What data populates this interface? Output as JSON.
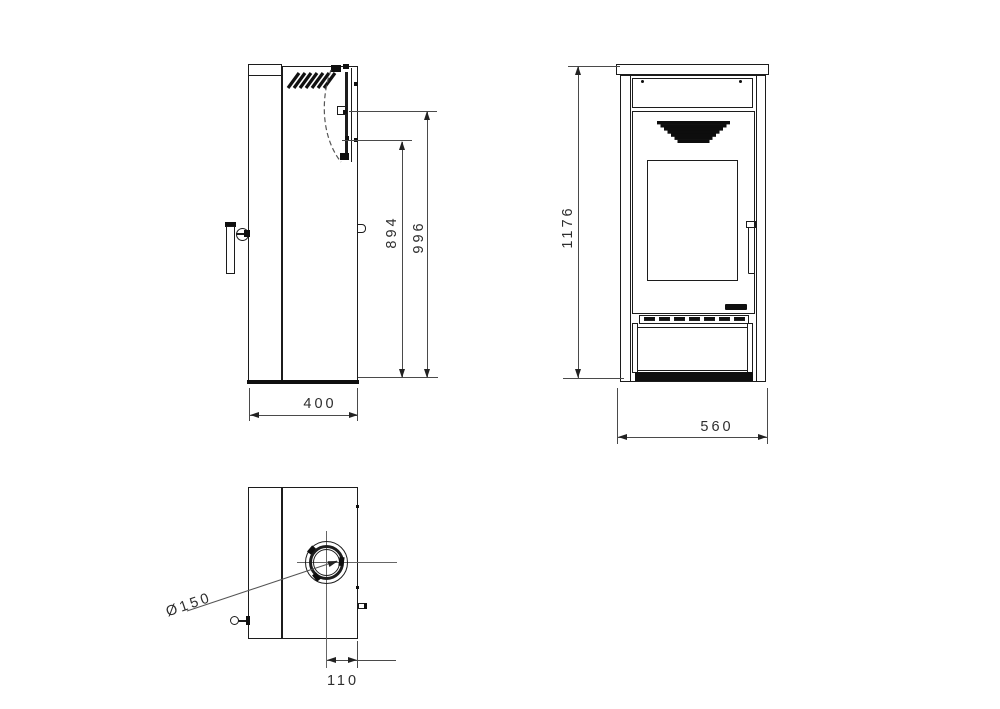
{
  "colors": {
    "background": "#ffffff",
    "object_line": "#1c1c1c",
    "dimension_line": "#4a4a4a",
    "solid_fill": "#0f0f0f",
    "text": "#2e2e2e"
  },
  "dimensions": {
    "side_depth": "400",
    "rear_outlet_height_lower": "894",
    "rear_outlet_height_upper": "996",
    "front_height": "1176",
    "front_width": "560",
    "flue_diameter": "Ø150",
    "flue_center_to_rear": "110"
  }
}
